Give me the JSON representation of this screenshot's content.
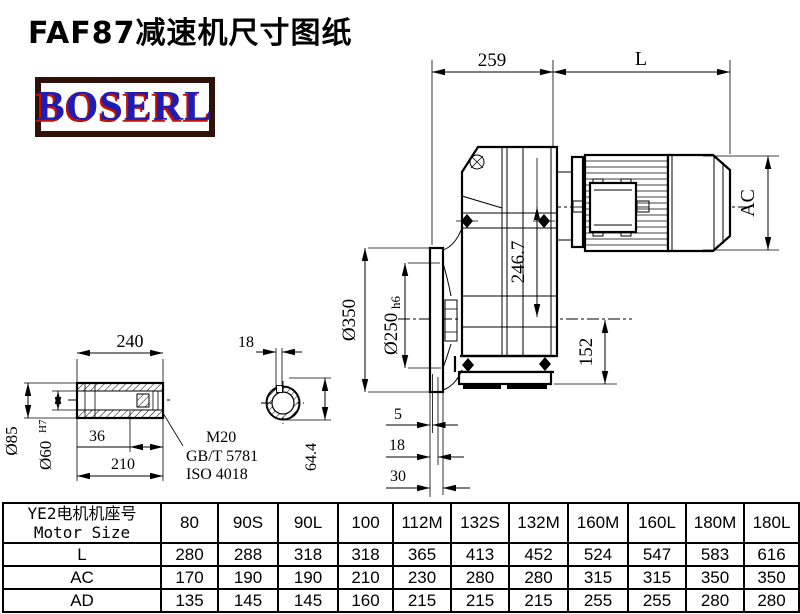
{
  "title": "FAF87减速机尺寸图纸",
  "logo": {
    "text": "BOSERL",
    "text_color": "#1d1cb5",
    "outline_color": "#c41200",
    "border_color": "#311009"
  },
  "drawing": {
    "dims": {
      "width_259": "259",
      "motor_length": "L",
      "motor_diameter": "AC",
      "flange_diameter": "Ø350",
      "hub_diameter": "Ø250",
      "hub_tolerance": "h6",
      "center_height_top": "246.7",
      "center_height_bottom": "152",
      "flange_step_1": "5",
      "flange_step_2": "18",
      "flange_step_3": "30",
      "shaft_length": "240",
      "shaft_outer_diameter": "Ø85",
      "shaft_bore_diameter": "Ø60",
      "shaft_bore_tolerance": "H7",
      "shaft_step_36": "36",
      "shaft_step_210": "210",
      "keyway_width": "18",
      "keyway_height": "64.4",
      "thread": "M20",
      "standard_gb": "GB/T 5781",
      "standard_iso": "ISO 4018"
    }
  },
  "table": {
    "header_cn": "YE2电机机座号",
    "header_en": "Motor Size",
    "sizes": [
      "80",
      "90S",
      "90L",
      "100",
      "112M",
      "132S",
      "132M",
      "160M",
      "160L",
      "180M",
      "180L"
    ],
    "rows": [
      {
        "label": "L",
        "values": [
          280,
          288,
          318,
          318,
          365,
          413,
          452,
          524,
          547,
          583,
          616
        ]
      },
      {
        "label": "AC",
        "values": [
          170,
          190,
          190,
          210,
          230,
          280,
          280,
          315,
          315,
          350,
          350
        ]
      },
      {
        "label": "AD",
        "values": [
          135,
          145,
          145,
          160,
          215,
          215,
          215,
          255,
          255,
          280,
          280
        ]
      }
    ]
  }
}
